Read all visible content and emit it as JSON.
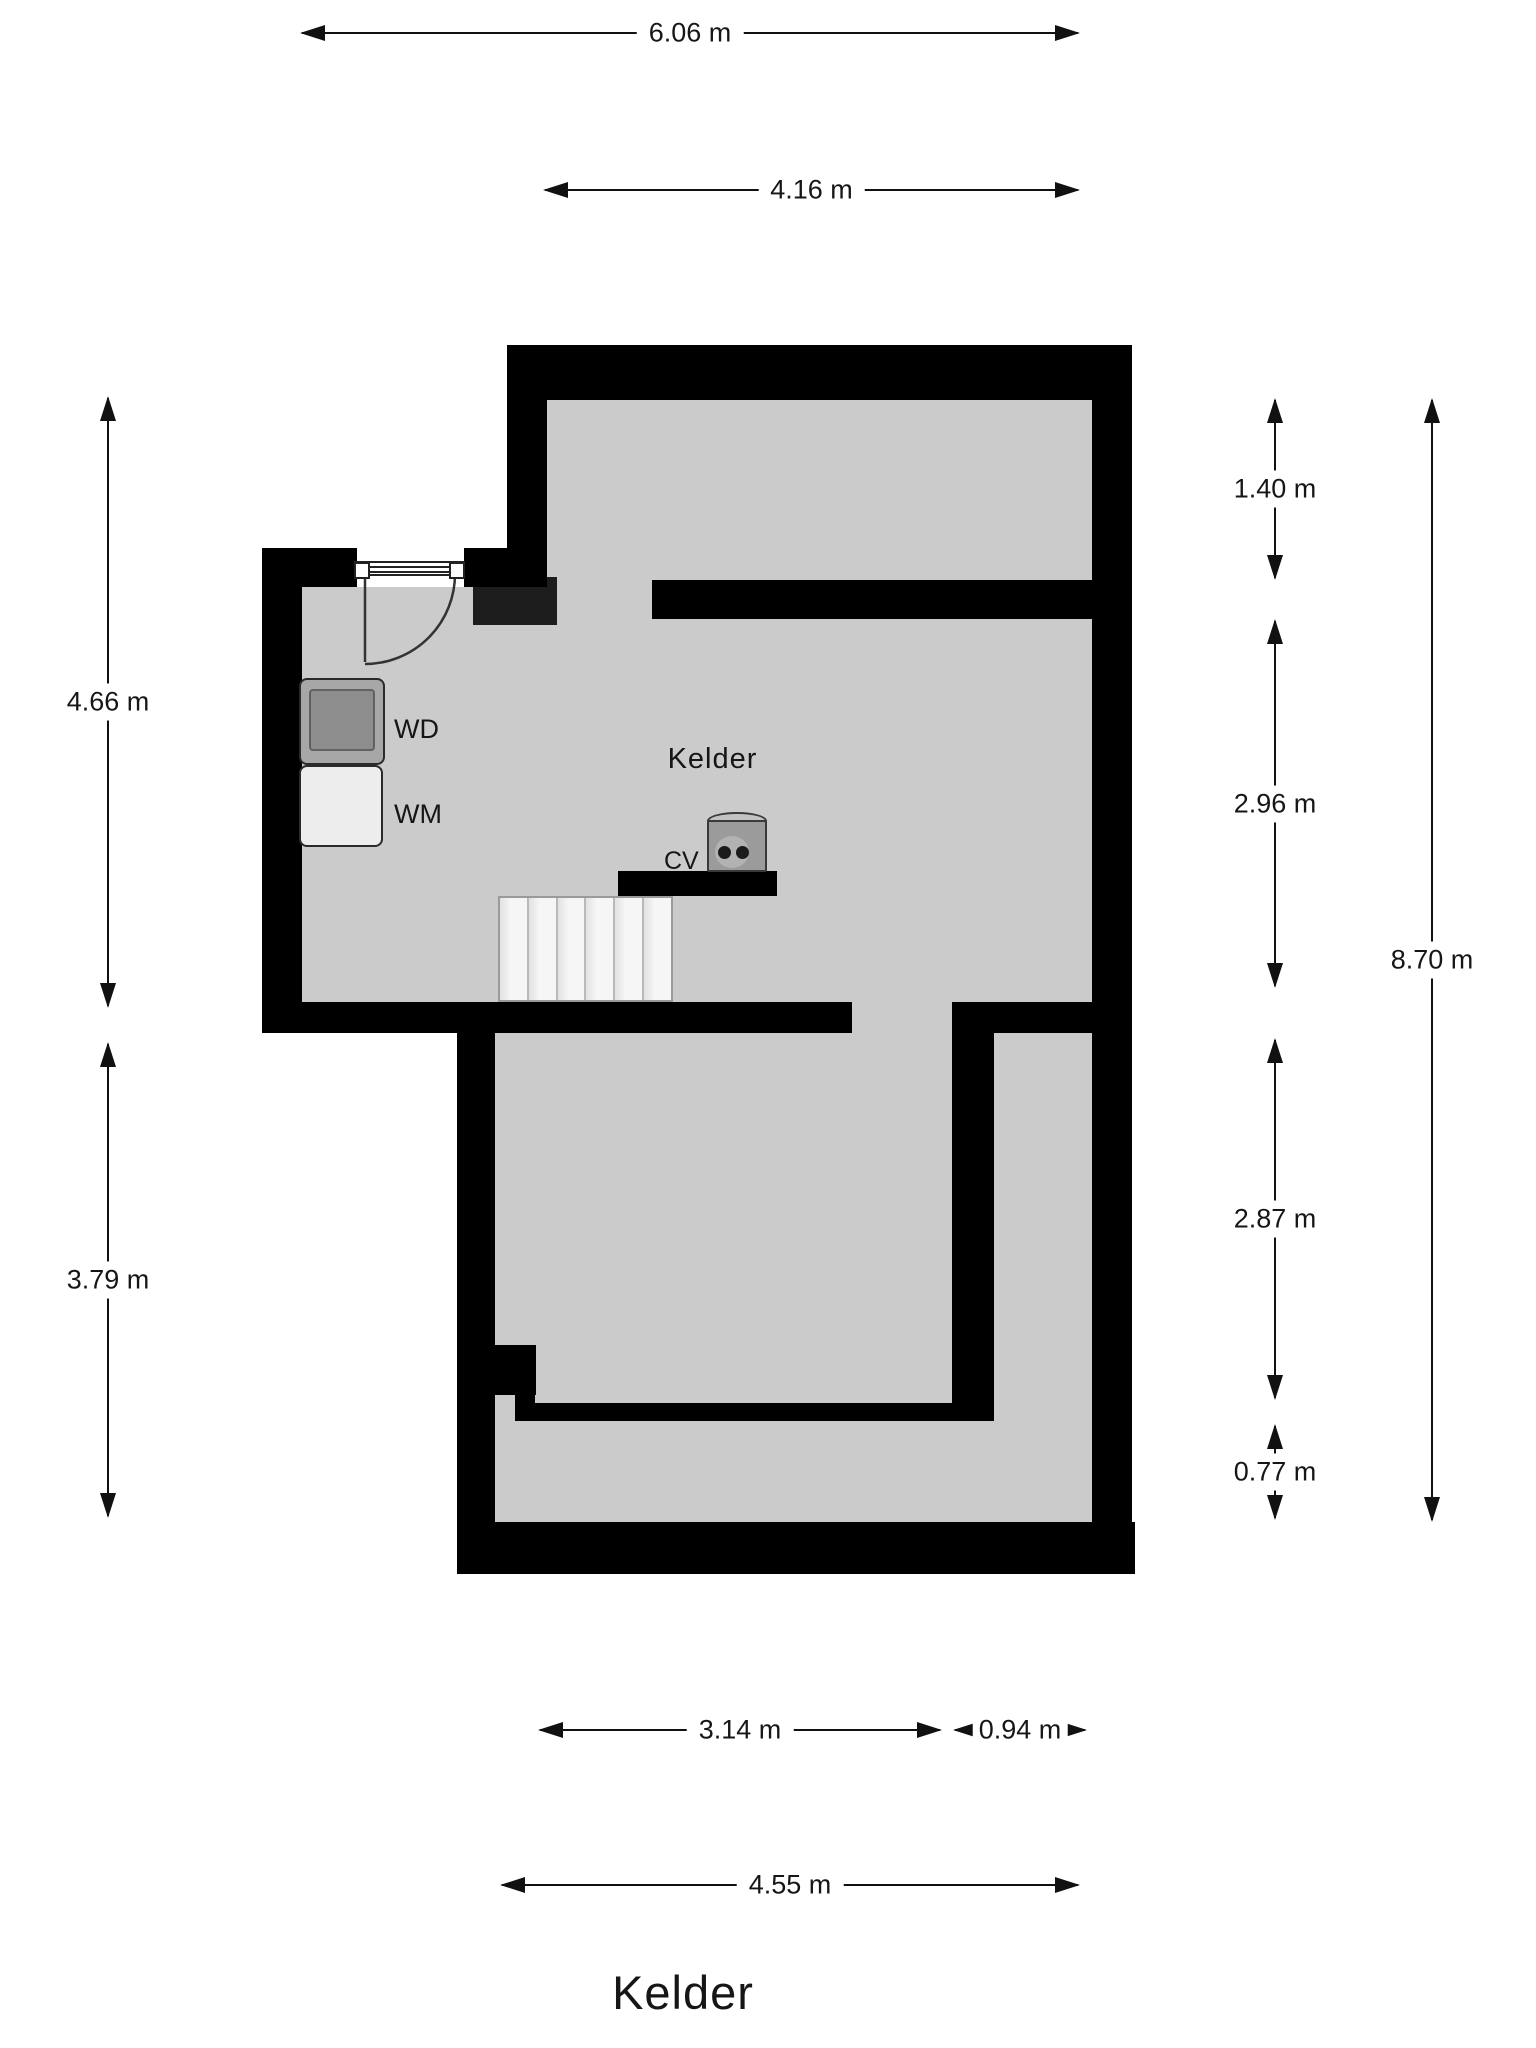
{
  "title": "Kelder",
  "room": {
    "label": "Kelder"
  },
  "appliances": {
    "wd": "WD",
    "wm": "WM",
    "cv": "CV"
  },
  "dimensions": {
    "top": [
      "6.06 m",
      "4.16 m"
    ],
    "left": [
      "4.66 m",
      "3.79 m"
    ],
    "right": [
      "1.40 m",
      "2.96 m",
      "2.87 m",
      "0.77 m",
      "8.70 m"
    ],
    "bottom": [
      "3.14 m",
      "0.94 m",
      "4.55 m"
    ]
  },
  "colors": {
    "wall": "#000000",
    "floor": "#cbcbcb",
    "stairs": "#f3f3f3",
    "chimney": "#1d1d1d",
    "appliance_dark": "#8d8d8d",
    "appliance_light": "#ededed",
    "boiler": "#9b9b9b",
    "text": "#111111"
  }
}
